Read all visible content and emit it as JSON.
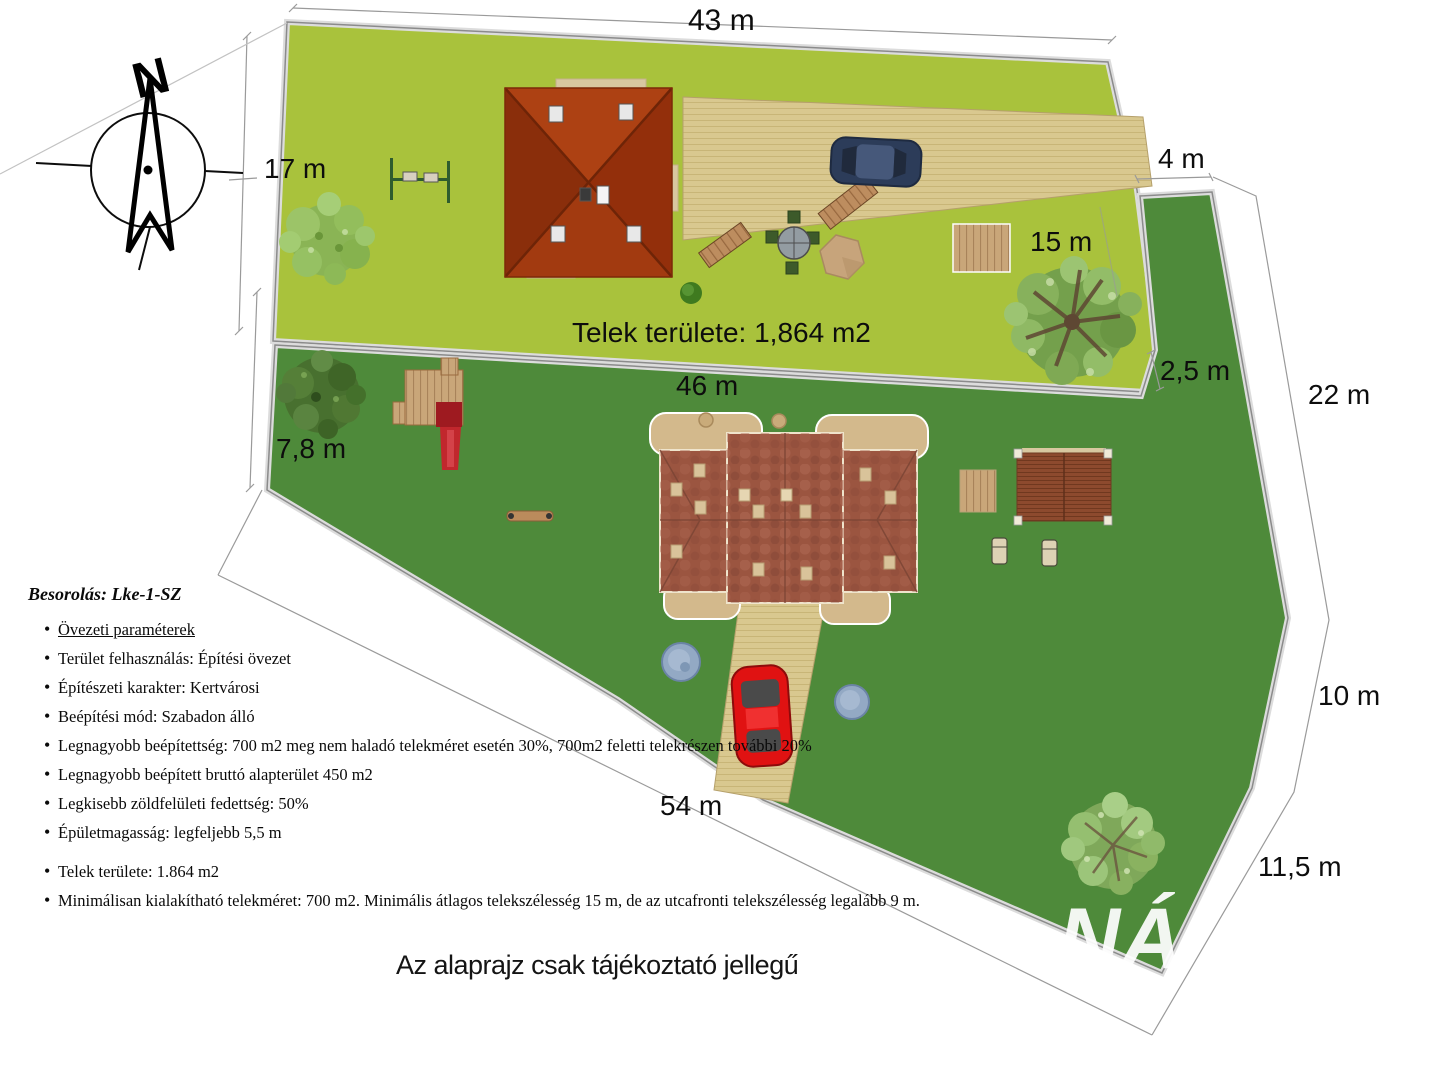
{
  "compass": {
    "north_label": "N"
  },
  "dimensions": {
    "top_width": "43 m",
    "left_width": "17 m",
    "gap_right": "4 m",
    "right_upper_width": "15 m",
    "notch": "2,5 m",
    "right_side_upper": "22 m",
    "middle_width": "46 m",
    "left_lower": "7,8 m",
    "right_side_mid": "10 m",
    "right_side_lower": "11,5 m",
    "bottom_width": "54 m"
  },
  "plot": {
    "area_label": "Telek területe: 1,864 m2"
  },
  "zoning": {
    "title": "Besorolás: Lke-1-SZ",
    "items": [
      {
        "text": "Övezeti paraméterek"
      },
      {
        "text": "Terület felhasználás: Építési övezet"
      },
      {
        "text": "Építészeti karakter: Kertvárosi"
      },
      {
        "text": "Beépítési mód: Szabadon álló"
      },
      {
        "text": "Legnagyobb beépítettség: 700 m2 meg nem haladó telekméret esetén 30%, 700m2 feletti telekrészen további 20%"
      },
      {
        "text": "Legnagyobb beépített bruttó alapterület 450 m2"
      },
      {
        "text": "Legkisebb zöldfelületi fedettség: 50%"
      },
      {
        "text": "Épületmagasság: legfeljebb  5,5 m"
      },
      {
        "text": "Telek területe: 1.864 m2"
      },
      {
        "text": "Minimálisan kialakítható telekméret: 700 m2. Minimális átlagos telekszélesség 15 m, de az utcafronti telekszélesség legalább 9 m."
      }
    ]
  },
  "footer": {
    "note": "Az alaprajz csak tájékoztató jellegű"
  },
  "watermark": {
    "text": "NÁ"
  },
  "colors": {
    "upper_plot_green": "#a9c23c",
    "lower_plot_green": "#4e8a3a",
    "driveway_tan": "#d9c88f",
    "upper_roof_red": "#a33a0f",
    "lower_roof_brown": "#9b5540",
    "car_red": "#e01212",
    "car_blue": "#2c3c59",
    "dimension_line_grey": "#9a9a9a"
  }
}
